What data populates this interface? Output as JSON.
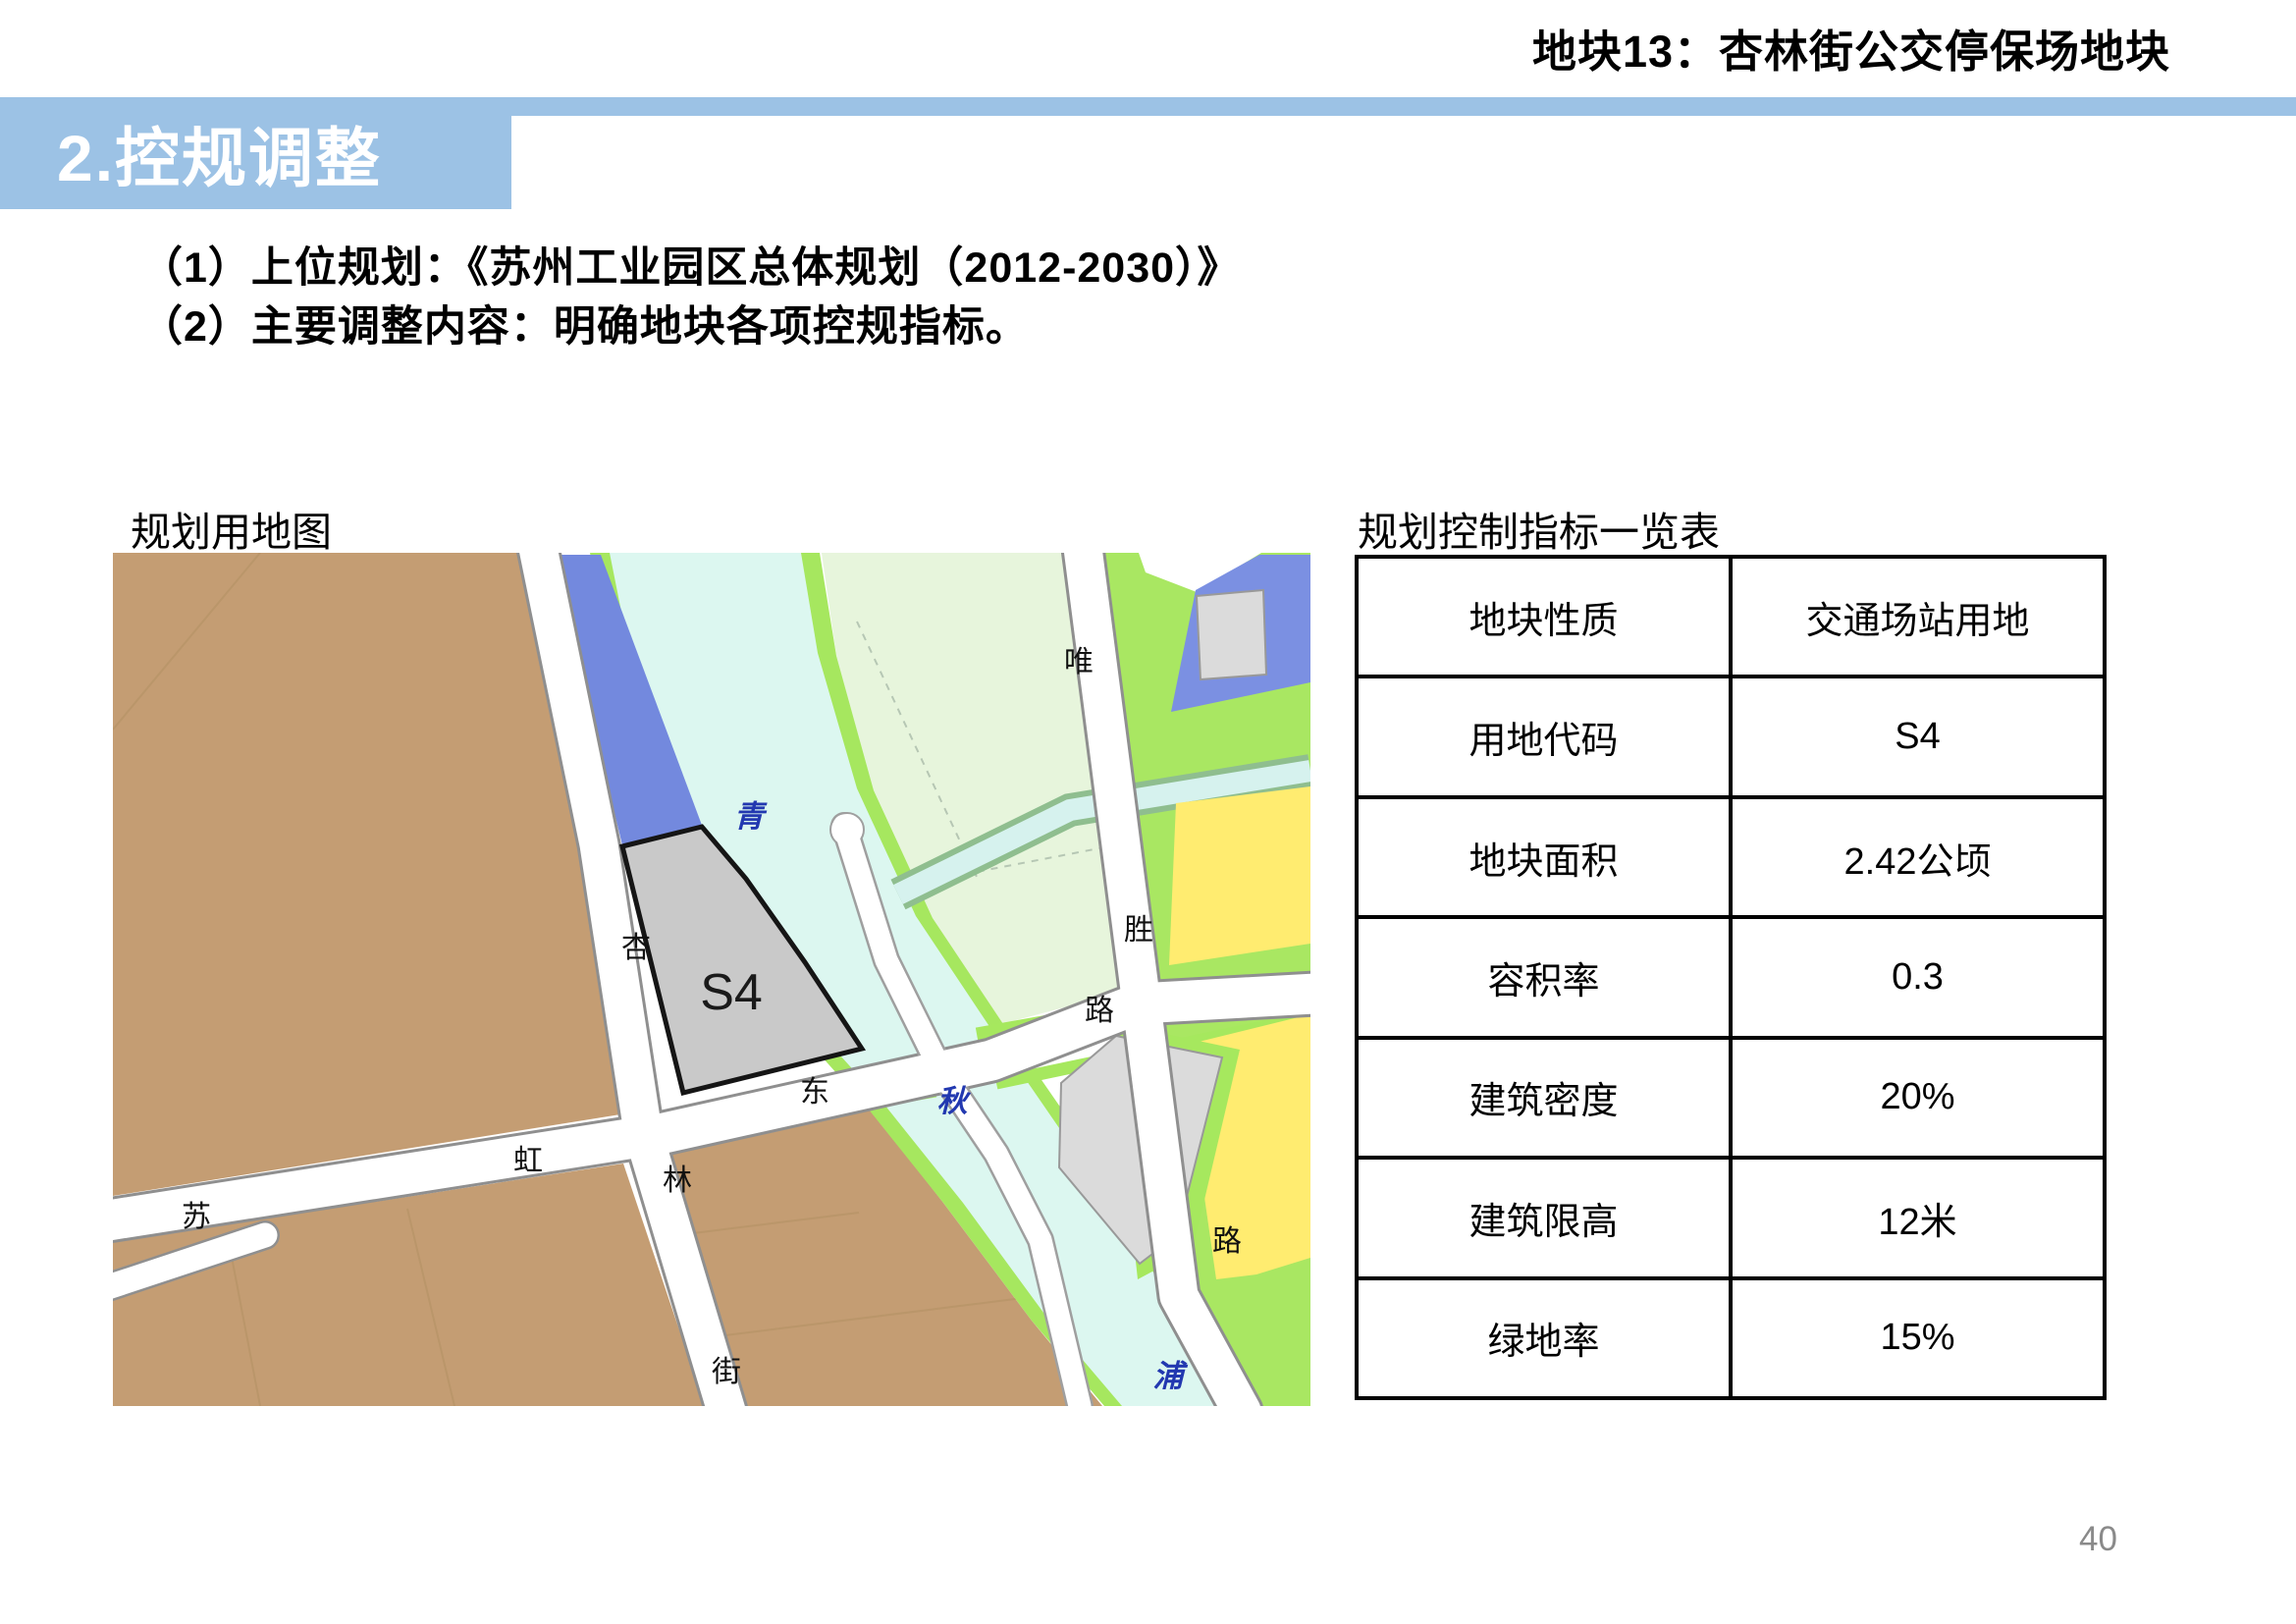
{
  "header": {
    "title": "地块13：杏林街公交停保场地块"
  },
  "banner": {
    "title": "2.控规调整"
  },
  "body": {
    "line1": "（1）上位规划：《苏州工业园区总体规划（2012-2030）》",
    "line2": "（2）主要调整内容：明确地块各项控规指标。"
  },
  "map": {
    "label": "规划用地图",
    "parcel_code": "S4",
    "road_labels": [
      {
        "text": "杏"
      },
      {
        "text": "林"
      },
      {
        "text": "街"
      },
      {
        "text": "苏"
      },
      {
        "text": "虹"
      },
      {
        "text": "东"
      },
      {
        "text": "路"
      },
      {
        "text": "唯"
      },
      {
        "text": "胜"
      },
      {
        "text": "路"
      }
    ],
    "river_labels": [
      {
        "text": "青"
      },
      {
        "text": "秋"
      },
      {
        "text": "浦"
      }
    ],
    "colors": {
      "banner_blue": "#9CC2E5",
      "farmland_brown": "#C49D73",
      "water_cyan": "#DCF7F0",
      "river_bank_green": "#A6E75F",
      "pale_green": "#E7F5DC",
      "parcel_green": "#A9E762",
      "parcel_blue": "#7389DE",
      "parcel_yellow": "#FFEC70",
      "parcel_gray_s4": "#C9C9C9",
      "parcel_light_gray": "#DBDBDB",
      "river_label_blue": "#2238B0"
    }
  },
  "table": {
    "label": "规划控制指标一览表",
    "rows": [
      {
        "name": "地块性质",
        "value": "交通场站用地"
      },
      {
        "name": "用地代码",
        "value": "S4"
      },
      {
        "name": "地块面积",
        "value": "2.42公顷"
      },
      {
        "name": "容积率",
        "value": "0.3"
      },
      {
        "name": "建筑密度",
        "value": "20%"
      },
      {
        "name": "建筑限高",
        "value": "12米"
      },
      {
        "name": "绿地率",
        "value": "15%"
      }
    ]
  },
  "page": {
    "number": "40"
  }
}
